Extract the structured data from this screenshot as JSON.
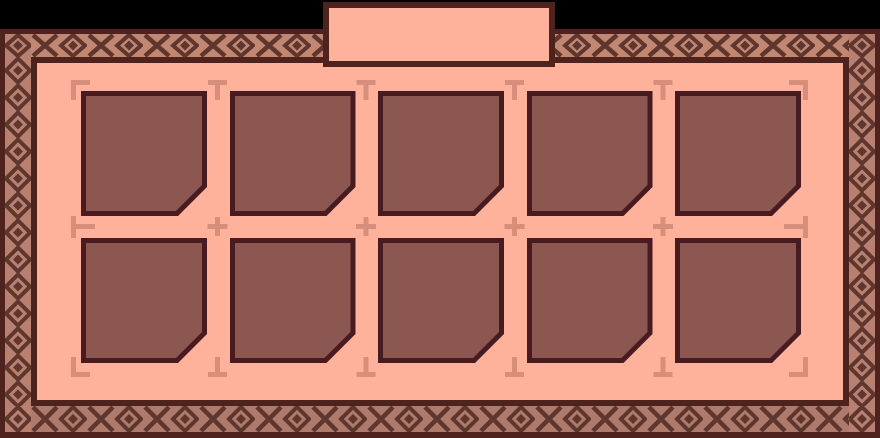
{
  "panel": {
    "tab": {
      "label": ""
    },
    "grid": {
      "rows": 2,
      "columns": 5,
      "slots": [
        {
          "state": "empty"
        },
        {
          "state": "empty"
        },
        {
          "state": "empty"
        },
        {
          "state": "empty"
        },
        {
          "state": "empty"
        },
        {
          "state": "empty"
        },
        {
          "state": "empty"
        },
        {
          "state": "empty"
        },
        {
          "state": "empty"
        },
        {
          "state": "empty"
        }
      ]
    },
    "markers": {
      "top": [
        "corner-tl",
        "t-down",
        "t-down",
        "t-down",
        "t-down",
        "corner-tr"
      ],
      "middle": [
        "t-right",
        "plus",
        "plus",
        "plus",
        "plus",
        "t-left"
      ],
      "bottom": [
        "corner-bl",
        "t-up",
        "t-up",
        "t-up",
        "t-up",
        "corner-br"
      ]
    },
    "border_pattern": {
      "horizontal_motifs": [
        "x-motif",
        "diamond-motif"
      ],
      "vertical_motifs": [
        "diamond-motif"
      ]
    }
  },
  "colors": {
    "background": "#000000",
    "frame": "#4e231d",
    "interior": "#ffb29b",
    "band_background_top": "#c28772",
    "band_background_side": "#b88070",
    "band_background_bottom": "#ae7a6c",
    "band_motif": "#5f362d",
    "slot_fill": "#8c5750",
    "slot_border": "#481b20",
    "marker": "#d78e7a"
  }
}
